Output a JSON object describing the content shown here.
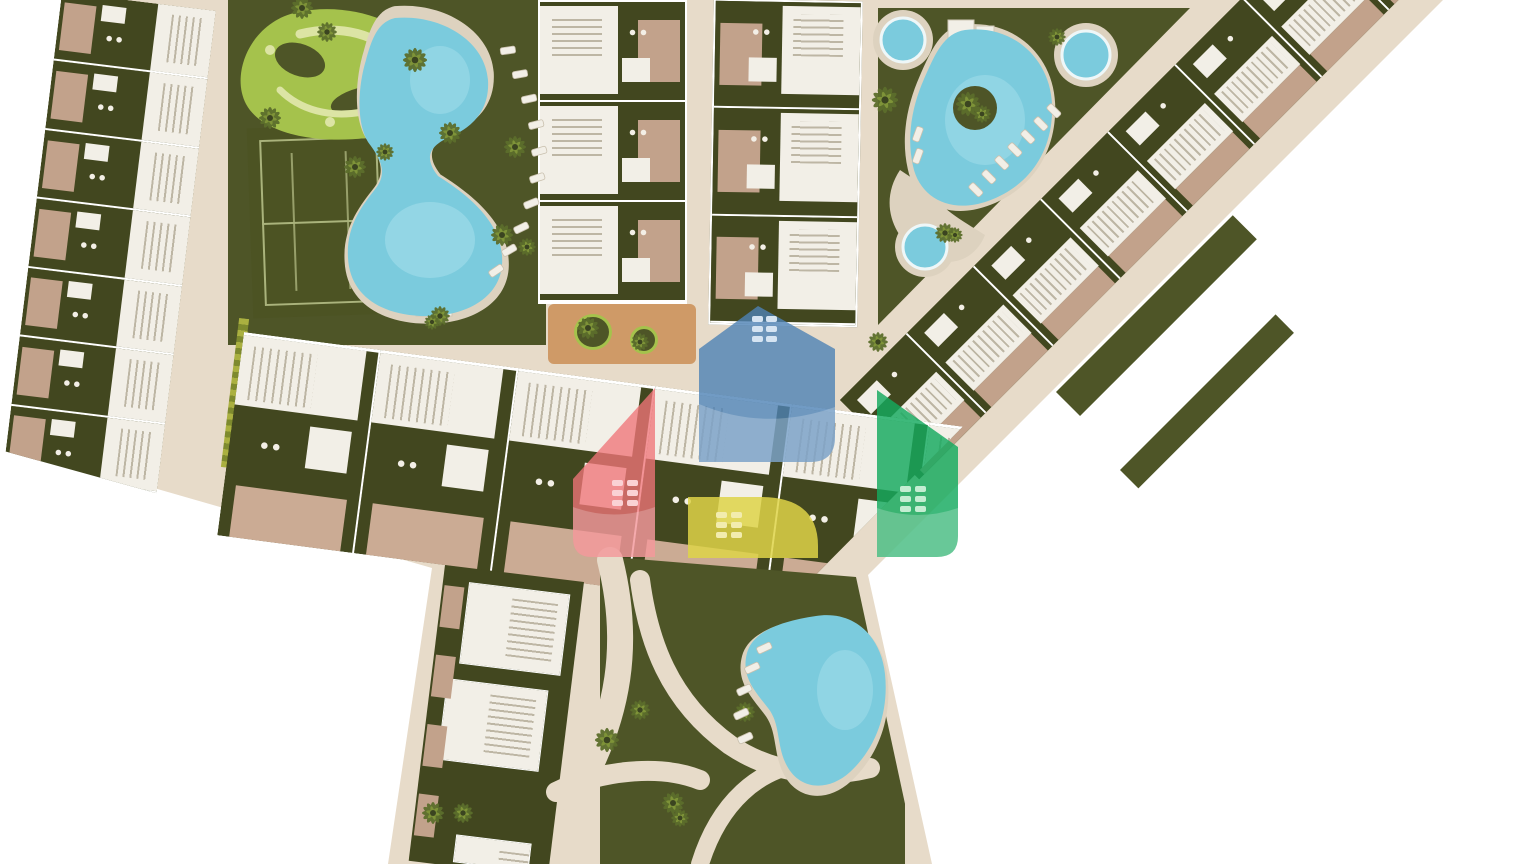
{
  "title": "Residential resort master plan – aerial site rendering",
  "colors": {
    "bg": "#ffffff",
    "road": "#e7dbc9",
    "deck": "#ddd2bf",
    "gdark": "#42471f",
    "gmid": "#4e5527",
    "lawnL": "#a5c24c",
    "lawnP": "#dce4a4",
    "pool": "#7bcbdd",
    "poolhi": "#b2e4ef",
    "bwhite": "#f2efe7",
    "bshadow": "#bdb6a4",
    "patio": "#c2a28b",
    "patioL": "#cbab94",
    "plaza": "#cf9a67",
    "court": "#4c5323",
    "courtline": "#aab37c",
    "furn": "#f3efe6",
    "hedge": "#aab040",
    "hedge2": "#7e8a2e",
    "palm_dark": "#3b4420",
    "palm_leaf": "#5c6e2c",
    "palm_lite": "#7e9338",
    "logo_blue": "#4d82b5",
    "logo_red": "#ef7479",
    "logo_green": "#14a95e",
    "logo_yellow": "#ded348"
  },
  "regions": {
    "left_row": {
      "name": "west townhouse row",
      "units": 7
    },
    "middle_row": {
      "name": "central townhouse row",
      "units": 6
    },
    "block_a": {
      "name": "north block A",
      "units": 3
    },
    "block_b": {
      "name": "north block B",
      "units": 3
    },
    "right_band": {
      "name": "northeast diagonal townhouse band",
      "units": 8
    },
    "south_cluster": {
      "name": "south villas and pool garden",
      "buildings": 3
    },
    "amenities": [
      "garden maze lawn",
      "tennis court",
      "lagoon pool",
      "triangle pool garden",
      "three round pools",
      "south kidney pool",
      "playground plaza"
    ]
  },
  "pools": {
    "round_pool_count": 3,
    "organic_pool_count": 3
  },
  "logo_overlay": {
    "houses": [
      "blue",
      "red",
      "green",
      "yellow"
    ]
  },
  "palms": [
    [
      302,
      8,
      1.0
    ],
    [
      327,
      32,
      0.9
    ],
    [
      415,
      60,
      1.1
    ],
    [
      270,
      118,
      1.0
    ],
    [
      355,
      167,
      1.0
    ],
    [
      385,
      152,
      0.8
    ],
    [
      450,
      133,
      1.0
    ],
    [
      515,
      147,
      1.0
    ],
    [
      502,
      235,
      1.0
    ],
    [
      527,
      247,
      0.8
    ],
    [
      440,
      316,
      0.9
    ],
    [
      432,
      322,
      0.7
    ],
    [
      588,
      328,
      1.0
    ],
    [
      640,
      342,
      0.8
    ],
    [
      878,
      342,
      0.9
    ],
    [
      885,
      100,
      1.2
    ],
    [
      968,
      104,
      1.1
    ],
    [
      982,
      114,
      0.8
    ],
    [
      1057,
      37,
      0.8
    ],
    [
      945,
      233,
      0.9
    ],
    [
      955,
      235,
      0.7
    ],
    [
      607,
      740,
      1.1
    ],
    [
      640,
      710,
      0.9
    ],
    [
      433,
      813,
      1.0
    ],
    [
      463,
      813,
      0.9
    ],
    [
      673,
      803,
      1.0
    ],
    [
      745,
      712,
      0.9
    ],
    [
      680,
      818,
      0.8
    ]
  ],
  "loungers": {
    "main_pool": [
      [
        500,
        48,
        -8
      ],
      [
        512,
        72,
        -10
      ],
      [
        521,
        97,
        -12
      ],
      [
        528,
        123,
        -14
      ],
      [
        531,
        150,
        -16
      ],
      [
        529,
        177,
        -18
      ],
      [
        523,
        203,
        -22
      ],
      [
        513,
        228,
        -26
      ],
      [
        501,
        251,
        -30
      ],
      [
        488,
        272,
        -34
      ]
    ],
    "triangle_pool": [
      [
        999,
        155,
        45
      ],
      [
        1012,
        142,
        45
      ],
      [
        1025,
        129,
        45
      ],
      [
        1038,
        116,
        45
      ],
      [
        1051,
        103,
        45
      ],
      [
        986,
        169,
        45
      ],
      [
        973,
        182,
        45
      ],
      [
        912,
        140,
        -70
      ],
      [
        912,
        162,
        -70
      ]
    ],
    "south_pool": [
      [
        756,
        648,
        -25
      ],
      [
        744,
        668,
        -25
      ],
      [
        736,
        690,
        -25
      ],
      [
        733,
        714,
        -25
      ],
      [
        737,
        738,
        -25
      ]
    ]
  }
}
